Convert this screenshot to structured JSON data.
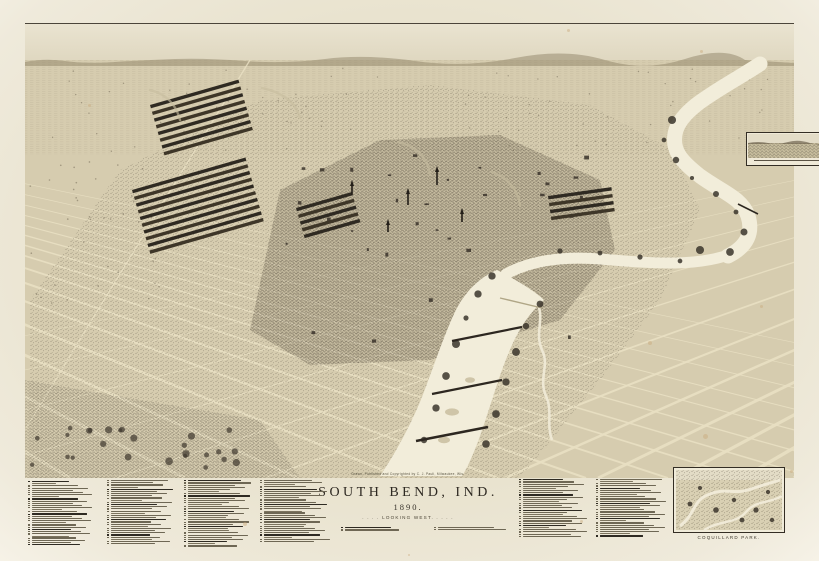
{
  "title_block": {
    "imprint": "Drawn, Published and Copyrighted by C. J. Pauli, Milwaukee, Wis.",
    "title": "SOUTH BEND, IND.",
    "year": "1890.",
    "subtitle": ". . . .   LOOKING WEST.   . . . ."
  },
  "insets": {
    "top_right": {
      "caption_legible": false
    },
    "bottom_right": {
      "caption": "COQUILLARD PARK."
    }
  },
  "legend": {
    "note": "Numbered index of businesses, churches and public buildings in illegible micro-text",
    "columns": [
      {
        "x": 28,
        "y": 481,
        "width": 64,
        "entries": 25
      },
      {
        "x": 107,
        "y": 480,
        "width": 66,
        "entries": 25
      },
      {
        "x": 184,
        "y": 480,
        "width": 68,
        "entries": 26
      },
      {
        "x": 260,
        "y": 480,
        "width": 70,
        "entries": 24
      },
      {
        "x": 519,
        "y": 479,
        "width": 68,
        "entries": 23
      },
      {
        "x": 596,
        "y": 479,
        "width": 70,
        "entries": 22
      }
    ],
    "title_refs": [
      {
        "x": 341,
        "y": 527,
        "width": 58,
        "entries": 2
      },
      {
        "x": 434,
        "y": 527,
        "width": 80,
        "entries": 2
      }
    ]
  },
  "colors": {
    "paper": "#ece6d3",
    "ink": "#2b2620",
    "river": "#f2edda",
    "ground": "#d6ccaf",
    "sky_top": "#eae4d1",
    "foxing": "#c9a87b"
  },
  "map": {
    "subject": "Bird's-eye panoramic lithograph of South Bend, Indiana with the St. Joseph River"
  }
}
